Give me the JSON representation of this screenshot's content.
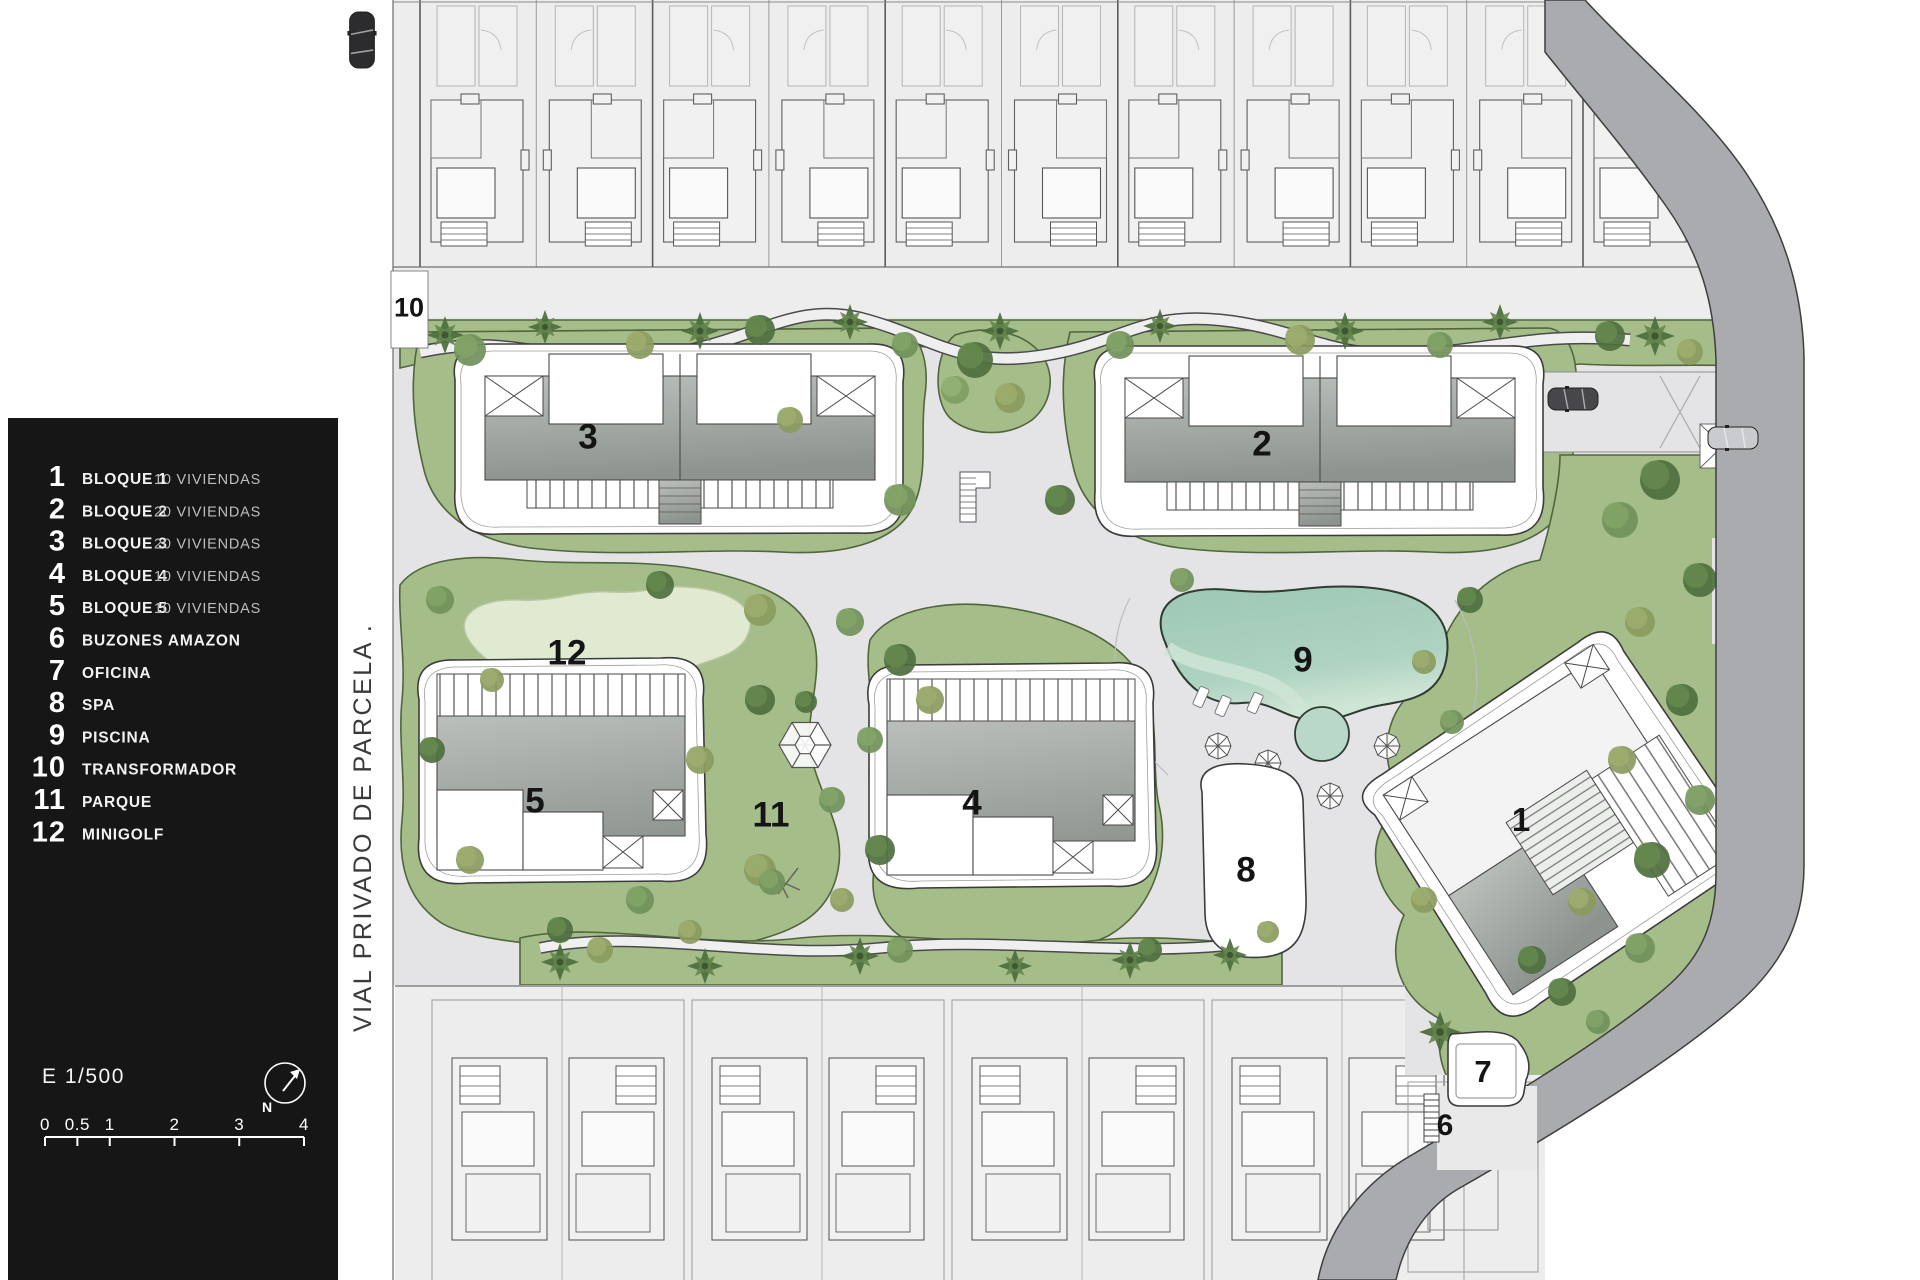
{
  "legend": {
    "items": [
      {
        "num": "1",
        "label": "BLOQUE 1",
        "detail": "10 VIVIENDAS"
      },
      {
        "num": "2",
        "label": "BLOQUE 2",
        "detail": "20 VIVIENDAS"
      },
      {
        "num": "3",
        "label": "BLOQUE 3",
        "detail": "20 VIVIENDAS"
      },
      {
        "num": "4",
        "label": "BLOQUE 4",
        "detail": "10 VIVIENDAS"
      },
      {
        "num": "5",
        "label": "BLOQUE 5",
        "detail": "10 VIVIENDAS"
      },
      {
        "num": "6",
        "label": "BUZONES AMAZON",
        "detail": ""
      },
      {
        "num": "7",
        "label": "OFICINA",
        "detail": ""
      },
      {
        "num": "8",
        "label": "SPA",
        "detail": ""
      },
      {
        "num": "9",
        "label": "PISCINA",
        "detail": ""
      },
      {
        "num": "10",
        "label": "TRANSFORMADOR",
        "detail": ""
      },
      {
        "num": "11",
        "label": "PARQUE",
        "detail": ""
      },
      {
        "num": "12",
        "label": "MINIGOLF",
        "detail": ""
      }
    ],
    "scale_text": "E 1/500",
    "north_label": "N",
    "scale_ticks": [
      "0",
      "0.5",
      "1",
      "2",
      "3",
      "4"
    ]
  },
  "street_label": "VIAL PRIVADO DE PARCELA .",
  "plan": {
    "markers": [
      {
        "num": "10",
        "x": 409,
        "y": 307,
        "size": 27
      },
      {
        "num": "3",
        "x": 588,
        "y": 436,
        "size": 35
      },
      {
        "num": "2",
        "x": 1262,
        "y": 443,
        "size": 35
      },
      {
        "num": "12",
        "x": 567,
        "y": 652,
        "size": 35
      },
      {
        "num": "9",
        "x": 1303,
        "y": 659,
        "size": 35
      },
      {
        "num": "5",
        "x": 535,
        "y": 800,
        "size": 35
      },
      {
        "num": "11",
        "x": 771,
        "y": 814,
        "size": 35
      },
      {
        "num": "4",
        "x": 972,
        "y": 802,
        "size": 35
      },
      {
        "num": "1",
        "x": 1521,
        "y": 819,
        "size": 33
      },
      {
        "num": "8",
        "x": 1246,
        "y": 869,
        "size": 35
      },
      {
        "num": "7",
        "x": 1483,
        "y": 1071,
        "size": 31
      },
      {
        "num": "6",
        "x": 1445,
        "y": 1124,
        "size": 30
      }
    ],
    "colors": {
      "panel": "#161616",
      "lawn": "#a4bd89",
      "lawn_edge": "#51663d",
      "path": "#e4e4e6",
      "pool": "#a8cfbc",
      "pool_light": "#d7e9db",
      "road": "#a9abae",
      "neighbor": "#ededee",
      "minigolf": "#e0ead0"
    }
  }
}
